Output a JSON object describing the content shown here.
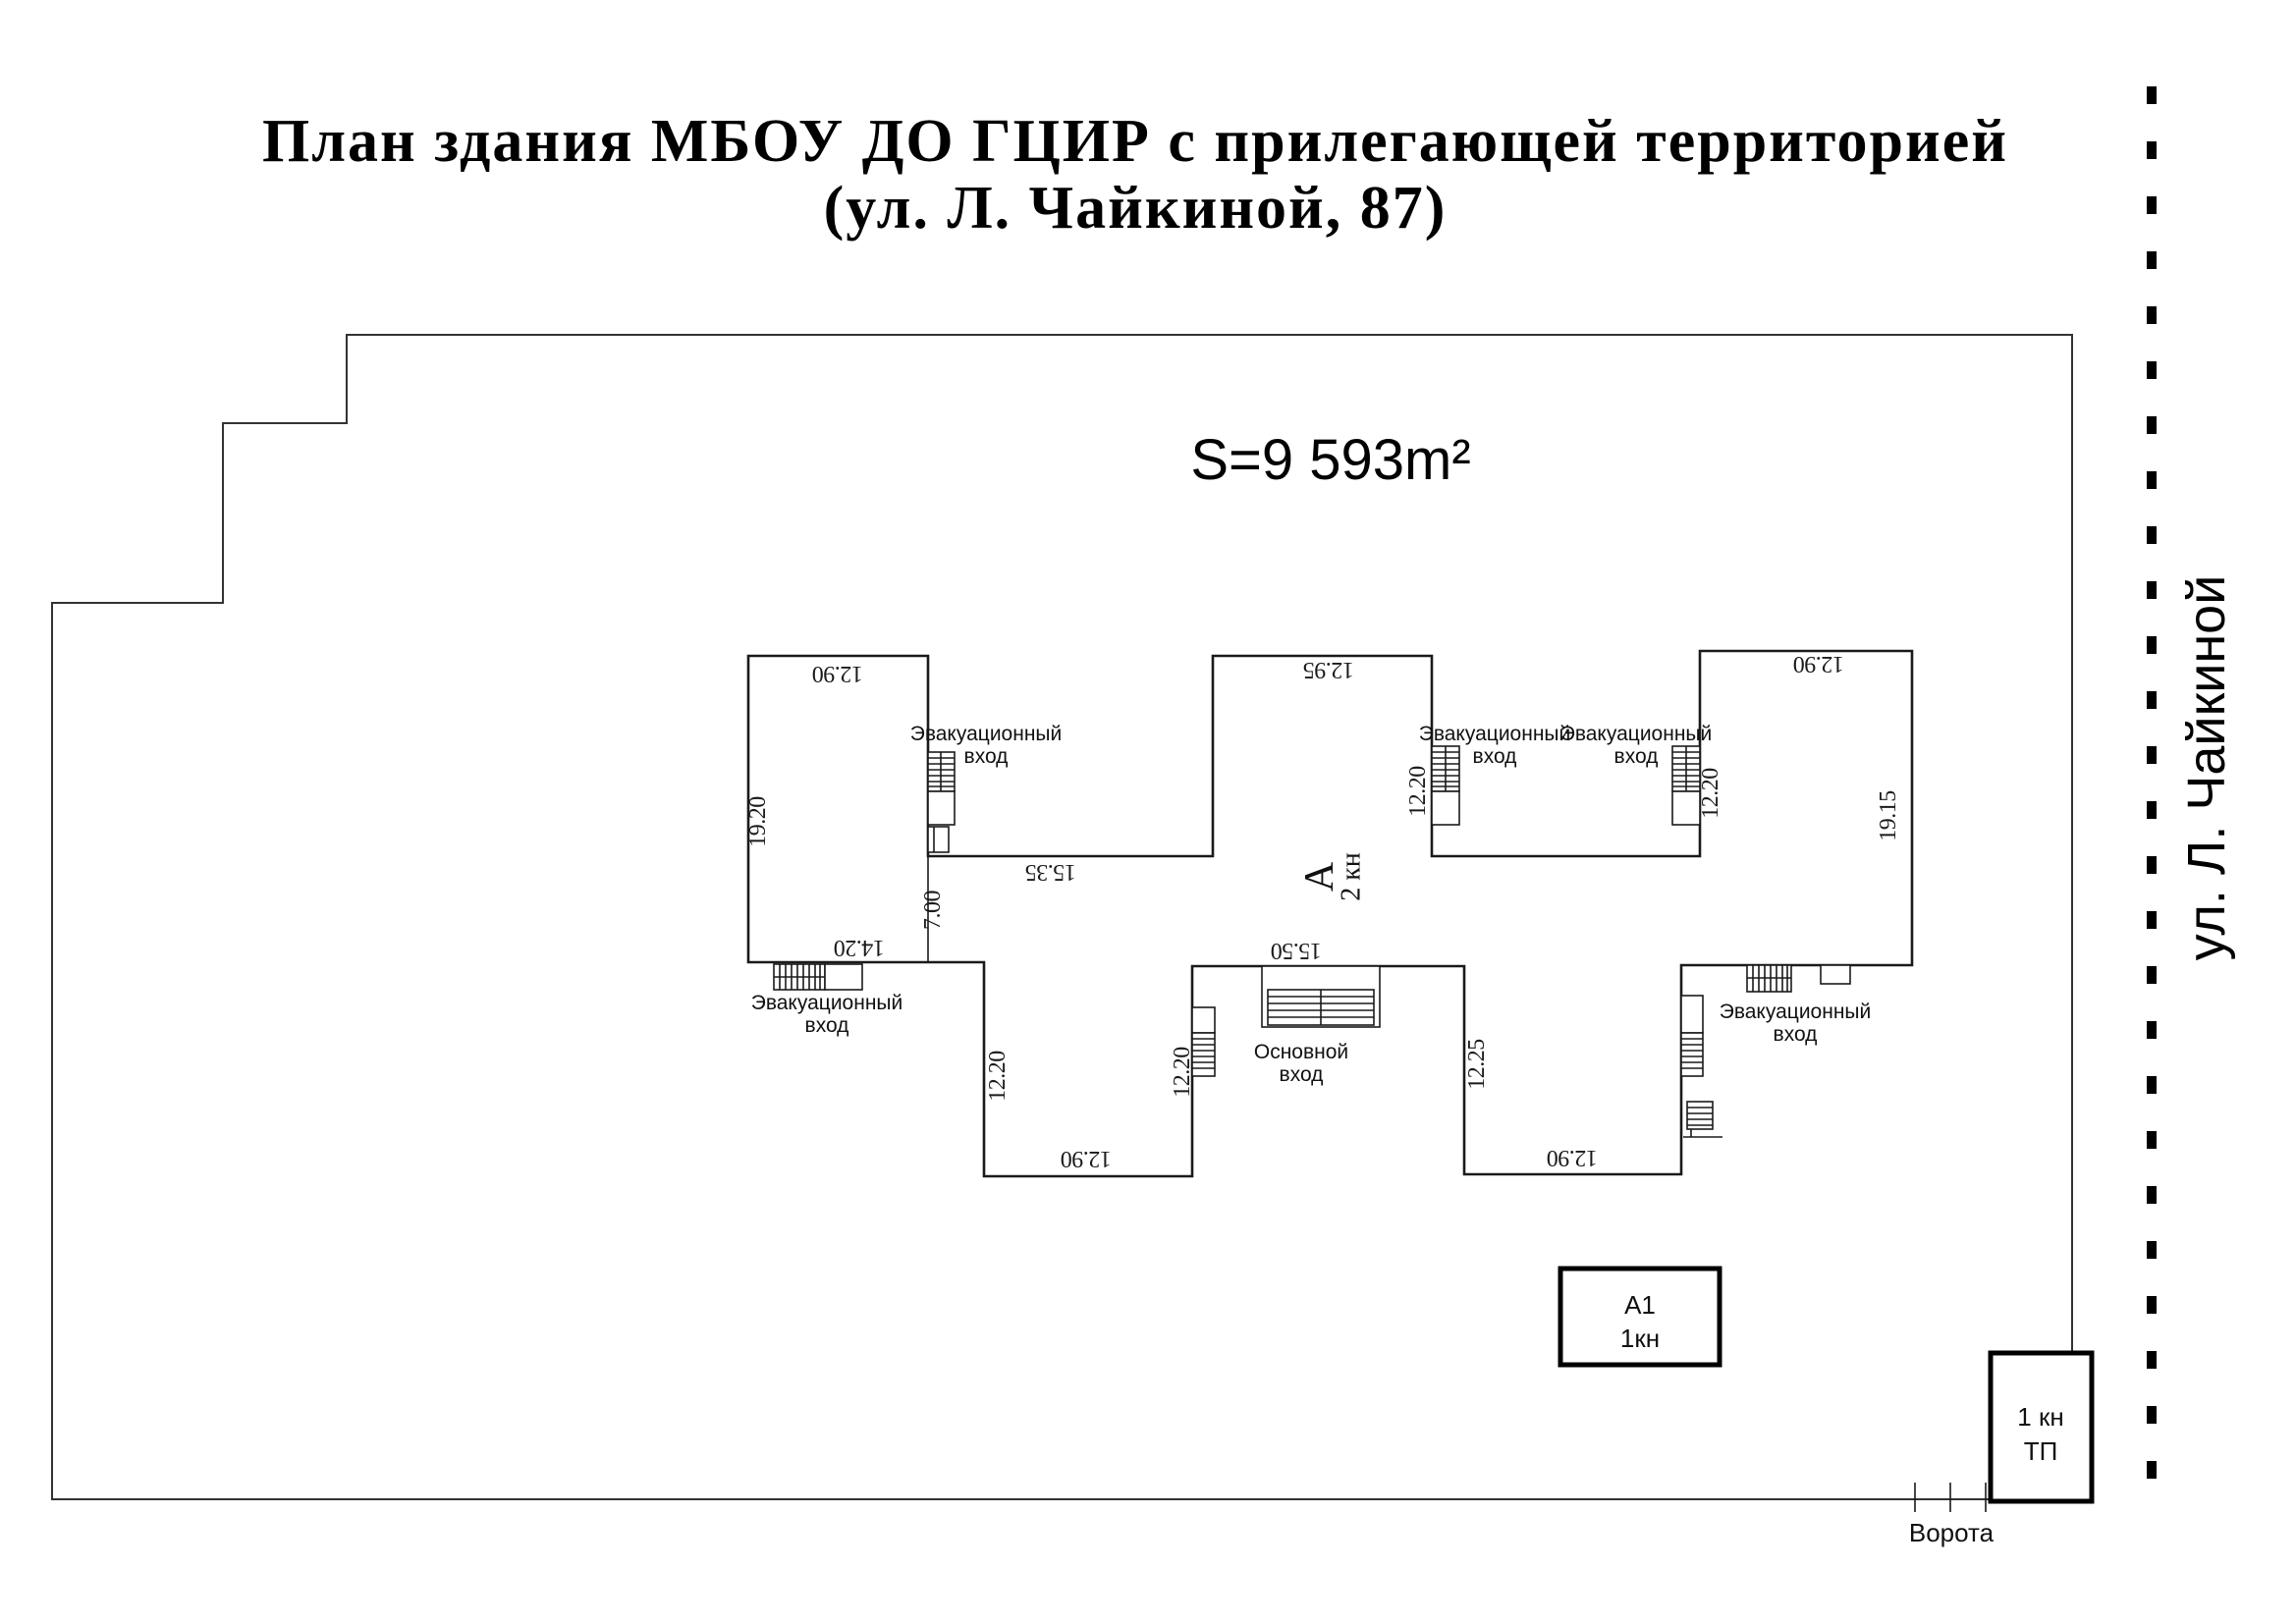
{
  "title": {
    "line1": "План здания МБОУ ДО ГЦИР с прилегающей территорией",
    "line2": "(ул. Л. Чайкиной, 87)"
  },
  "area_label": "S=9 593m²",
  "street_label": "ул. Л. Чайкиной",
  "gate_label": "Ворота",
  "labels": {
    "evac": {
      "line1": "Эвакуационный",
      "line2": "вход"
    },
    "main": {
      "line1": "Основной",
      "line2": "вход"
    }
  },
  "building_marks": {
    "block_a": {
      "letter": "А",
      "sub": "2 кн"
    },
    "a1_box": {
      "line1": "А1",
      "line2": "1кн"
    },
    "tp_box": {
      "line1": "1 кн",
      "line2": "ТП"
    }
  },
  "dims": {
    "left_block_top": "12.90",
    "mid_block_top": "12.95",
    "right_block_top": "12.90",
    "left_block_height": "19.20",
    "recess1_width": "15.35",
    "spine_height": "7.00",
    "left_block_bottom": "14.20",
    "mid_stair_side": "12.20",
    "right_stair_side": "12.20",
    "right_block_height": "19.15",
    "main_entrance_width": "15.50",
    "wing_left_west": "12.20",
    "wing_left_east": "12.20",
    "wing_left_bottom": "12.90",
    "wing_right_west": "12.25",
    "wing_right_bottom": "12.90"
  },
  "colors": {
    "walls": "#1a1a1a",
    "territory": "#333333",
    "street_line": "#000000"
  }
}
